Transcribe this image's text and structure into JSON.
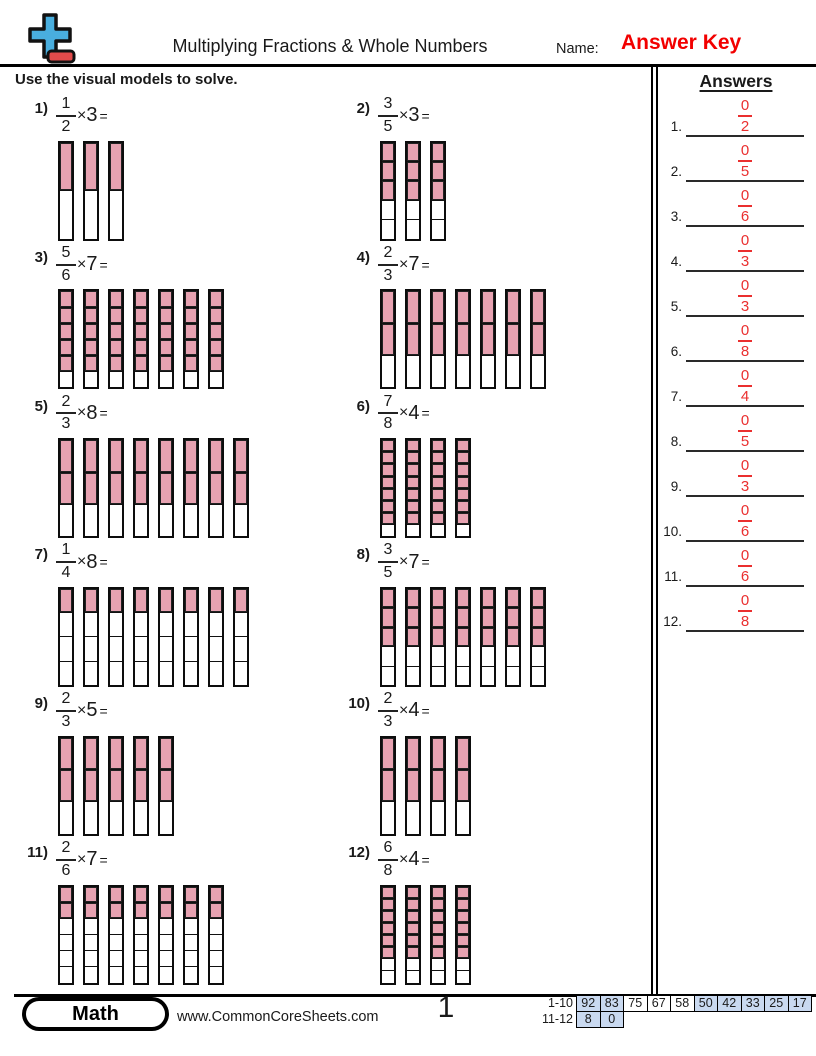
{
  "header": {
    "title": "Multiplying Fractions & Whole Numbers",
    "name_label": "Name:",
    "name_value": "Answer Key"
  },
  "instruction": "Use the visual models to solve.",
  "answers_panel": {
    "title": "Answers",
    "items": [
      {
        "num": "1.",
        "numerator": "0",
        "denominator": "2"
      },
      {
        "num": "2.",
        "numerator": "0",
        "denominator": "5"
      },
      {
        "num": "3.",
        "numerator": "0",
        "denominator": "6"
      },
      {
        "num": "4.",
        "numerator": "0",
        "denominator": "3"
      },
      {
        "num": "5.",
        "numerator": "0",
        "denominator": "3"
      },
      {
        "num": "6.",
        "numerator": "0",
        "denominator": "8"
      },
      {
        "num": "7.",
        "numerator": "0",
        "denominator": "4"
      },
      {
        "num": "8.",
        "numerator": "0",
        "denominator": "5"
      },
      {
        "num": "9.",
        "numerator": "0",
        "denominator": "3"
      },
      {
        "num": "10.",
        "numerator": "0",
        "denominator": "6"
      },
      {
        "num": "11.",
        "numerator": "0",
        "denominator": "6"
      },
      {
        "num": "12.",
        "numerator": "0",
        "denominator": "8"
      }
    ]
  },
  "problems": [
    {
      "num": "1)",
      "numerator": "1",
      "denominator": "2",
      "times": "×",
      "multiplier": "3",
      "equals": "=",
      "bars": 3,
      "segments": 2,
      "filled": 1
    },
    {
      "num": "2)",
      "numerator": "3",
      "denominator": "5",
      "times": "×",
      "multiplier": "3",
      "equals": "=",
      "bars": 3,
      "segments": 5,
      "filled": 3
    },
    {
      "num": "3)",
      "numerator": "5",
      "denominator": "6",
      "times": "×",
      "multiplier": "7",
      "equals": "=",
      "bars": 7,
      "segments": 6,
      "filled": 5
    },
    {
      "num": "4)",
      "numerator": "2",
      "denominator": "3",
      "times": "×",
      "multiplier": "7",
      "equals": "=",
      "bars": 7,
      "segments": 3,
      "filled": 2
    },
    {
      "num": "5)",
      "numerator": "2",
      "denominator": "3",
      "times": "×",
      "multiplier": "8",
      "equals": "=",
      "bars": 8,
      "segments": 3,
      "filled": 2
    },
    {
      "num": "6)",
      "numerator": "7",
      "denominator": "8",
      "times": "×",
      "multiplier": "4",
      "equals": "=",
      "bars": 4,
      "segments": 8,
      "filled": 7
    },
    {
      "num": "7)",
      "numerator": "1",
      "denominator": "4",
      "times": "×",
      "multiplier": "8",
      "equals": "=",
      "bars": 8,
      "segments": 4,
      "filled": 1
    },
    {
      "num": "8)",
      "numerator": "3",
      "denominator": "5",
      "times": "×",
      "multiplier": "7",
      "equals": "=",
      "bars": 7,
      "segments": 5,
      "filled": 3
    },
    {
      "num": "9)",
      "numerator": "2",
      "denominator": "3",
      "times": "×",
      "multiplier": "5",
      "equals": "=",
      "bars": 5,
      "segments": 3,
      "filled": 2
    },
    {
      "num": "10)",
      "numerator": "2",
      "denominator": "3",
      "times": "×",
      "multiplier": "4",
      "equals": "=",
      "bars": 4,
      "segments": 3,
      "filled": 2
    },
    {
      "num": "11)",
      "numerator": "2",
      "denominator": "6",
      "times": "×",
      "multiplier": "7",
      "equals": "=",
      "bars": 7,
      "segments": 6,
      "filled": 2
    },
    {
      "num": "12)",
      "numerator": "6",
      "denominator": "8",
      "times": "×",
      "multiplier": "4",
      "equals": "=",
      "bars": 4,
      "segments": 8,
      "filled": 6
    }
  ],
  "footer": {
    "brand": "Math",
    "website": "www.CommonCoreSheets.com",
    "page_number": "1",
    "score_table": {
      "row1_label": "1-10",
      "row1": [
        {
          "v": "92",
          "hl": true
        },
        {
          "v": "83",
          "hl": true
        },
        {
          "v": "75",
          "hl": false
        },
        {
          "v": "67",
          "hl": false
        },
        {
          "v": "58",
          "hl": false
        },
        {
          "v": "50",
          "hl": true
        },
        {
          "v": "42",
          "hl": true
        },
        {
          "v": "33",
          "hl": true
        },
        {
          "v": "25",
          "hl": true
        },
        {
          "v": "17",
          "hl": true
        }
      ],
      "row2_label": "11-12",
      "row2": [
        {
          "v": "8",
          "hl": true
        },
        {
          "v": "0",
          "hl": true
        }
      ]
    }
  },
  "colors": {
    "bar_fill": "#e7a2b1",
    "answer_red": "#ea2f2f",
    "answer_key_red": "#f20000",
    "cell_blue": "#c9d9f0",
    "logo_blue": "#49aede",
    "logo_red": "#e24b4b"
  }
}
